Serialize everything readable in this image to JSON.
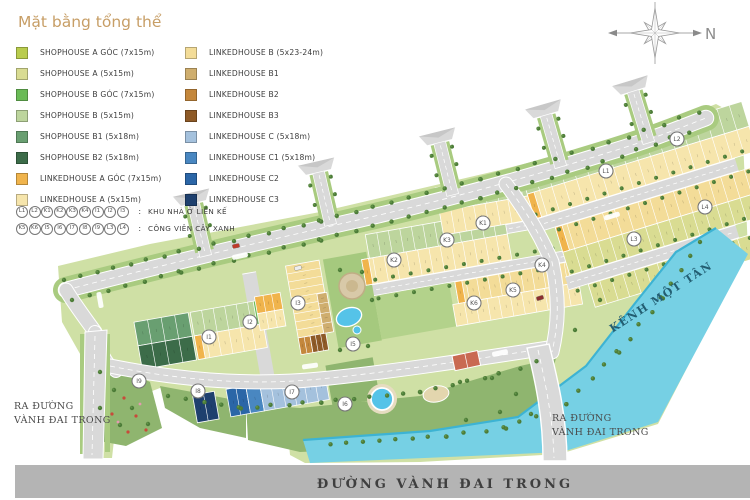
{
  "title": "Mặt bằng tổng thể",
  "compass": {
    "north_label": "N"
  },
  "legend": {
    "left": [
      {
        "label": "SHOPHOUSE A GÓC (7x15m)",
        "color": "#b9cc4d"
      },
      {
        "label": "SHOPHOUSE A  (5x15m)",
        "color": "#d9dc92"
      },
      {
        "label": "SHOPHOUSE B GÓC (7x15m)",
        "color": "#6abb56"
      },
      {
        "label": "SHOPHOUSE B  (5x15m)",
        "color": "#bdd59d"
      },
      {
        "label": "SHOPHOUSE B1 (5x18m)",
        "color": "#699f71"
      },
      {
        "label": "SHOPHOUSE B2 (5x18m)",
        "color": "#3c6c49"
      },
      {
        "label": "LINKEDHOUSE A GÓC (7x15m)",
        "color": "#f0b44c"
      },
      {
        "label": "LINKEDHOUSE A (5x15m)",
        "color": "#f6e5ac"
      }
    ],
    "right": [
      {
        "label": "LINKEDHOUSE B (5x23-24m)",
        "color": "#f3dc98"
      },
      {
        "label": "LINKEDHOUSE B1",
        "color": "#cfae6e"
      },
      {
        "label": "LINKEDHOUSE B2",
        "color": "#c4873c"
      },
      {
        "label": "LINKEDHOUSE B3",
        "color": "#8e5a27"
      },
      {
        "label": "LINKEDHOUSE C (5x18m)",
        "color": "#a4c1dd"
      },
      {
        "label": "LINKEDHOUSE C1 (5x18m)",
        "color": "#4987c1"
      },
      {
        "label": "LINKEDHOUSE C2",
        "color": "#2b66a7"
      },
      {
        "label": "LINKEDHOUSE C3",
        "color": "#1e406e"
      }
    ]
  },
  "legend_keys": [
    {
      "codes": [
        "L1",
        "L2",
        "K1",
        "K2",
        "K3",
        "K4",
        "I1",
        "I2",
        "I3"
      ],
      "separator": ":",
      "label": "KHU NHÀ Ở LIÊN KẾ"
    },
    {
      "codes": [
        "K5",
        "K6",
        "I5",
        "I6",
        "I7",
        "I8",
        "I9",
        "L3",
        "L4"
      ],
      "separator": ":",
      "label": "CÔNG VIÊN CÂY XANH"
    }
  ],
  "map": {
    "markers": [
      {
        "code": "L1",
        "x": 606,
        "y": 171
      },
      {
        "code": "L2",
        "x": 677,
        "y": 139
      },
      {
        "code": "K1",
        "x": 483,
        "y": 223
      },
      {
        "code": "K2",
        "x": 394,
        "y": 260
      },
      {
        "code": "K3",
        "x": 447,
        "y": 240
      },
      {
        "code": "K4",
        "x": 542,
        "y": 265
      },
      {
        "code": "I1",
        "x": 209,
        "y": 337
      },
      {
        "code": "I2",
        "x": 250,
        "y": 322
      },
      {
        "code": "I3",
        "x": 298,
        "y": 303
      },
      {
        "code": "K5",
        "x": 513,
        "y": 290
      },
      {
        "code": "K6",
        "x": 474,
        "y": 303
      },
      {
        "code": "I5",
        "x": 353,
        "y": 344
      },
      {
        "code": "I6",
        "x": 345,
        "y": 404
      },
      {
        "code": "I7",
        "x": 292,
        "y": 392
      },
      {
        "code": "I8",
        "x": 198,
        "y": 391
      },
      {
        "code": "I9",
        "x": 139,
        "y": 381
      },
      {
        "code": "L3",
        "x": 634,
        "y": 239
      },
      {
        "code": "L4",
        "x": 705,
        "y": 207
      }
    ],
    "labels": {
      "canal": {
        "text": "KÊNH MỘT TÂN"
      },
      "bottom_road": {
        "text": "ĐƯỜNG VÀNH ĐAI TRONG"
      },
      "exit_left": {
        "lines": [
          "RA ĐƯỜNG",
          "VÀNH ĐAI TRONG"
        ]
      },
      "exit_right": {
        "lines": [
          "RA ĐƯỜNG",
          "VÀNH ĐAI TRONG"
        ]
      }
    }
  },
  "palette": {
    "ground": "#cfe0a5",
    "verge": "#a9cb80",
    "park": "#8fb56f",
    "tree_dark": "#4c7c38",
    "tree_light": "#649549",
    "road": "#d9d9d9",
    "road_line": "#ffffff",
    "main_road": "#b4b4b4",
    "canal": "#76d0e4",
    "canal_edge": "#3db3d3",
    "pool": "#55c3e8",
    "plaza": "#d8c9a8",
    "sand": "#e3d6ae",
    "court": "#c96a52",
    "title_color": "#c79e66",
    "label_dark": "#3f3f3f",
    "canal_label_color": "#235e72",
    "lot_colors": {
      "shAg": "#b9cc4d",
      "shA": "#d9dc92",
      "shBg": "#6abb56",
      "shB": "#bdd59d",
      "shB1": "#699f71",
      "shB2": "#3c6c49",
      "lhAg": "#f0b44c",
      "lhA": "#f6e5ac",
      "lhB": "#f3dc98",
      "lhB1": "#cfae6e",
      "lhB2": "#c4873c",
      "lhB3": "#8e5a27",
      "lhC": "#a4c1dd",
      "lhC1": "#4987c1",
      "lhC2": "#2b66a7",
      "lhC3": "#1e406e"
    }
  }
}
